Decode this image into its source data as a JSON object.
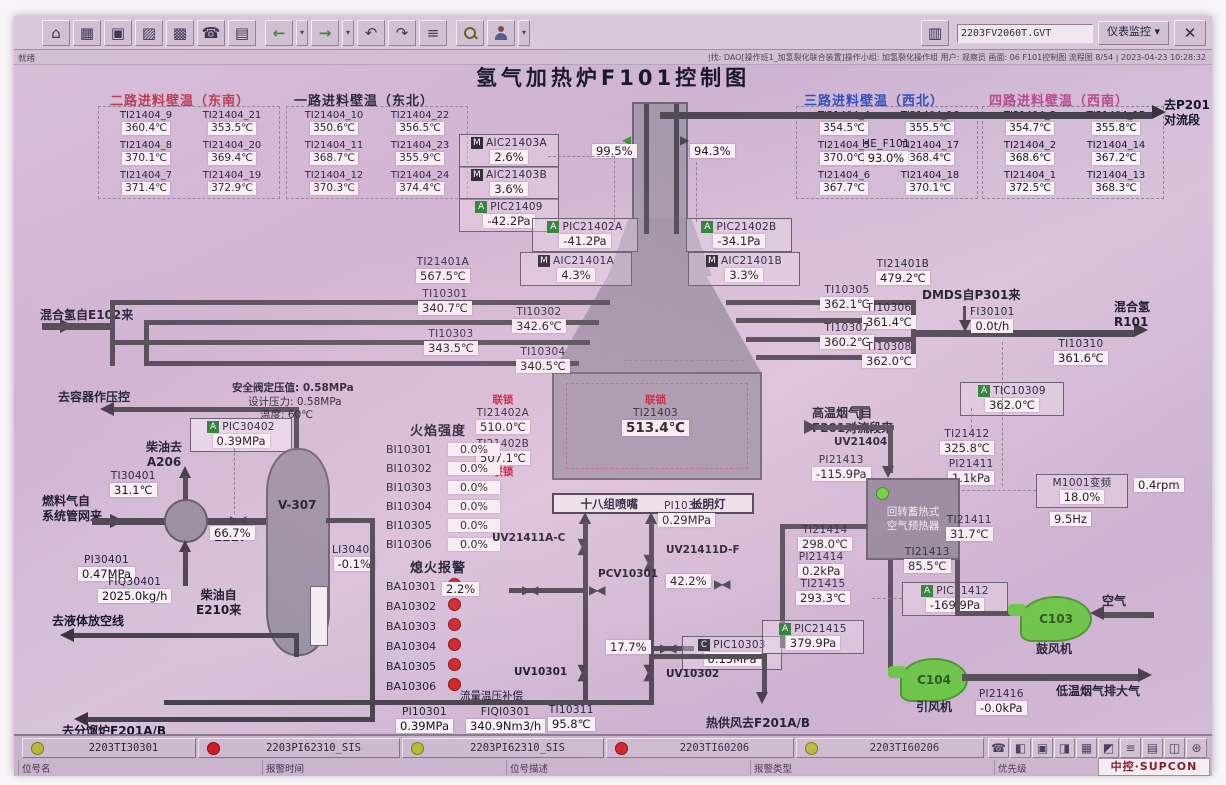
{
  "window": {
    "status_left": "就绪",
    "filename": "2203FV2060T.GVT",
    "view_btn": "仪表监控",
    "close": "✕",
    "info_bar": "|找: DAO[操作班1_加氢裂化联合装置]操作小组: 加氢裂化操作组 用户: 观察员 画面: 06 F101控制图 流程图 8/54 | 2023-04-23 10:28:32",
    "toolbar_icons": [
      {
        "name": "home",
        "glyph": "⌂"
      },
      {
        "name": "flowsheet",
        "glyph": "▦"
      },
      {
        "name": "monitor",
        "glyph": "▣"
      },
      {
        "name": "factory",
        "glyph": "▨"
      },
      {
        "name": "grid",
        "glyph": "▩"
      },
      {
        "name": "phone",
        "glyph": "☎"
      },
      {
        "name": "report",
        "glyph": "▤"
      },
      {
        "name": "back",
        "glyph": "←"
      },
      {
        "name": "forward",
        "glyph": "→"
      },
      {
        "name": "page-prev",
        "glyph": "↶"
      },
      {
        "name": "page-next",
        "glyph": "↷"
      },
      {
        "name": "book",
        "glyph": "≡"
      }
    ],
    "sys_icons": [
      {
        "name": "phone",
        "glyph": "☎"
      },
      {
        "name": "lock",
        "glyph": "◧"
      },
      {
        "name": "monitor",
        "glyph": "▣"
      },
      {
        "name": "printer",
        "glyph": "◨"
      },
      {
        "name": "table",
        "glyph": "▦"
      },
      {
        "name": "alarm",
        "glyph": "◩"
      },
      {
        "name": "list",
        "glyph": "≡"
      },
      {
        "name": "report",
        "glyph": "▤"
      },
      {
        "name": "window",
        "glyph": "◫"
      },
      {
        "name": "settings",
        "glyph": "⊛"
      }
    ]
  },
  "title": "氢气加热炉F101控制图",
  "feed_tables": [
    {
      "header": "二路进料壁温（东南）",
      "color": "#b5344e",
      "rows": [
        [
          "TI21404_9",
          "360.4℃",
          "TI21404_21",
          "353.5℃"
        ],
        [
          "TI21404_8",
          "370.1℃",
          "TI21404_20",
          "369.4℃"
        ],
        [
          "TI21404_7",
          "371.4℃",
          "TI21404_19",
          "372.9℃"
        ]
      ]
    },
    {
      "header": "一路进料壁温（东北）",
      "color": "#1c1c2e",
      "rows": [
        [
          "TI21404_10",
          "350.6℃",
          "TI21404_22",
          "356.5℃"
        ],
        [
          "TI21404_11",
          "368.7℃",
          "TI21404_23",
          "355.9℃"
        ],
        [
          "TI21404_12",
          "370.3℃",
          "TI21404_24",
          "374.4℃"
        ]
      ]
    },
    {
      "header": "三路进料壁温（西北）",
      "color": "#2a4fc0",
      "rows": [
        [
          "TI21404_4",
          "354.5℃",
          "TI21404_16",
          "355.5℃"
        ],
        [
          "TI21404_5",
          "370.0℃",
          "TI21404_17",
          "368.4℃"
        ],
        [
          "TI21404_6",
          "367.7℃",
          "TI21404_18",
          "370.1℃"
        ]
      ]
    },
    {
      "header": "四路进料壁温（西南）",
      "color": "#b84a8c",
      "rows": [
        [
          "TI21404_3",
          "354.7℃",
          "TI21404_15",
          "355.8℃"
        ],
        [
          "TI21404_2",
          "368.6℃",
          "TI21404_14",
          "367.2℃"
        ],
        [
          "TI21404_1",
          "372.5℃",
          "TI21404_13",
          "368.3℃"
        ]
      ]
    }
  ],
  "inst": {
    "aic21403a": {
      "mode": "M",
      "tag": "AIC21403A",
      "value": "2.6%"
    },
    "aic21403b": {
      "mode": "M",
      "tag": "AIC21403B",
      "value": "3.6%"
    },
    "pic21409": {
      "mode": "A",
      "tag": "PIC21409",
      "value": "-42.2Pa"
    },
    "pic21402a": {
      "mode": "A",
      "tag": "PIC21402A",
      "value": "-41.2Pa"
    },
    "pic21402b": {
      "mode": "A",
      "tag": "PIC21402B",
      "value": "-34.1Pa"
    },
    "aic21401a": {
      "mode": "M",
      "tag": "AIC21401A",
      "value": "4.3%"
    },
    "aic21401b": {
      "mode": "M",
      "tag": "AIC21401B",
      "value": "3.3%"
    },
    "he_f101": {
      "tag": "HE_F101",
      "value": "93.0%"
    },
    "damper_a": {
      "value": "99.5%"
    },
    "damper_b": {
      "value": "94.3%"
    },
    "ti21401a": {
      "tag": "TI21401A",
      "value": "567.5℃"
    },
    "ti21401b": {
      "tag": "TI21401B",
      "value": "479.2℃"
    },
    "ti10301": {
      "tag": "TI10301",
      "value": "340.7℃"
    },
    "ti10302": {
      "tag": "TI10302",
      "value": "342.6℃"
    },
    "ti10303": {
      "tag": "TI10303",
      "value": "343.5℃"
    },
    "ti10304": {
      "tag": "TI10304",
      "value": "340.5℃"
    },
    "ti10305": {
      "tag": "TI10305",
      "value": "362.1℃"
    },
    "ti10306": {
      "tag": "TI10306",
      "value": "361.4℃"
    },
    "ti10307": {
      "tag": "TI10307",
      "value": "360.2℃"
    },
    "ti10308": {
      "tag": "TI10308",
      "value": "362.0℃"
    },
    "fi30101": {
      "tag": "FI30101",
      "value": "0.0t/h"
    },
    "ti10310": {
      "tag": "TI10310",
      "value": "361.6℃"
    },
    "tic10309": {
      "mode": "A",
      "tag": "TIC10309",
      "value": "362.0℃"
    },
    "ti21402a": {
      "tag": "TI21402A",
      "value": "510.0℃"
    },
    "ti21402b": {
      "tag": "TI21402B",
      "value": "507.1℃"
    },
    "ti21403": {
      "tag": "TI21403",
      "value": "513.4℃"
    },
    "pic30402": {
      "mode": "A",
      "tag": "PIC30402",
      "value": "0.39MPa"
    },
    "ti30401": {
      "tag": "TI30401",
      "value": "31.1℃"
    },
    "pi30401": {
      "tag": "PI30401",
      "value": "0.47MPa"
    },
    "fiq30401": {
      "tag": "FIQ30401",
      "value": "2025.0kg/h"
    },
    "li30401": {
      "tag": "LI30401",
      "value": "-0.1%"
    },
    "valve_e217": {
      "value": "66.7%"
    },
    "pi10302": {
      "tag": "PI10302",
      "value": "0.29MPa"
    },
    "pic10303": {
      "mode": "C",
      "tag": "PIC10303",
      "value": "0.15MPa"
    },
    "valve_22": {
      "value": "2.2%"
    },
    "valve_422": {
      "value": "42.2%"
    },
    "valve_177": {
      "value": "17.7%"
    },
    "pi10301": {
      "tag": "PI10301",
      "value": "0.39MPa"
    },
    "fiqi0301": {
      "tag": "FIQI0301",
      "value": "340.9Nm3/h"
    },
    "ti10311": {
      "tag": "TI10311",
      "value": "95.8℃"
    },
    "uv10301": "UV10301",
    "uv10302": "UV10302",
    "pcv10301": "PCV10301",
    "uv21411ac": "UV21411A-C",
    "uv21411df": "UV21411D-F",
    "uv21404": "UV21404",
    "ti21412": {
      "tag": "TI21412",
      "value": "325.8℃"
    },
    "pi21413": {
      "tag": "PI21413",
      "value": "-115.9Pa"
    },
    "pi21411": {
      "tag": "PI21411",
      "value": "1.1kPa"
    },
    "m1001": {
      "tag": "M1001变频",
      "value": "18.0%",
      "value2": "9.5Hz",
      "rpm": "0.4rpm"
    },
    "ti21411": {
      "tag": "TI21411",
      "value": "31.7℃"
    },
    "ti21414": {
      "tag": "TI21414",
      "value": "298.0℃"
    },
    "pi21414": {
      "tag": "PI21414",
      "value": "0.2kPa"
    },
    "ti21413": {
      "tag": "TI21413",
      "value": "85.5℃"
    },
    "ti21415": {
      "tag": "TI21415",
      "value": "293.3℃"
    },
    "pic21412": {
      "mode": "A",
      "tag": "PIC21412",
      "value": "-169.9Pa"
    },
    "pic21415": {
      "mode": "A",
      "tag": "PIC21415",
      "value": "379.9Pa"
    },
    "pi21416": {
      "tag": "PI21416",
      "value": "-0.0kPa"
    }
  },
  "flame": {
    "header": "火焰强度",
    "rows": [
      {
        "tag": "BI10301",
        "value": "0.0%"
      },
      {
        "tag": "BI10302",
        "value": "0.0%"
      },
      {
        "tag": "BI10303",
        "value": "0.0%"
      },
      {
        "tag": "BI10304",
        "value": "0.0%"
      },
      {
        "tag": "BI10305",
        "value": "0.0%"
      },
      {
        "tag": "BI10306",
        "value": "0.0%"
      }
    ]
  },
  "flameout": {
    "header": "熄火报警",
    "tags": [
      "BA10301",
      "BA10302",
      "BA10303",
      "BA10304",
      "BA10305",
      "BA10306"
    ]
  },
  "equip": {
    "v307": "V-307",
    "e217": "E217",
    "c103": "C103",
    "c104": "C104",
    "blower": "鼓风机",
    "idfan": "引风机",
    "preheater1": "回转蓄热式",
    "preheater2": "空气预热器",
    "burners": "十八组喷嘴",
    "pilot": "长明灯",
    "interlock": "联锁"
  },
  "labels": {
    "to_p201_1": "去P201",
    "to_p201_2": "对流段",
    "mix_h2_from": "混合氢自E102来",
    "mix_h2_to1": "混合氢",
    "mix_h2_to2": "R101",
    "dmds": "DMDS自P301来",
    "to_vessel": "去容器作压控",
    "safety": "安全阀定压值: 0.58MPa",
    "design": "设计压力: 0.58MPa",
    "temp": "温度: 60℃",
    "diesel_to1": "柴油去",
    "diesel_to2": "A206",
    "fuel_from1": "燃料气自",
    "fuel_from2": "系统管网来",
    "diesel_from1": "柴油自",
    "diesel_from2": "E210来",
    "to_vent": "去液体放空线",
    "to_f201": "去分馏炉F201A/B",
    "hot_air": "热供风去F201A/B",
    "flow_comp": "流量温压补偿",
    "flue_from1": "高温烟气自",
    "flue_from2": "F201对流段来",
    "air": "空气",
    "flue_out": "低温烟气排大气"
  },
  "alarm_bar": {
    "items": [
      {
        "color": "#b9ba33",
        "tag": "2203TI30301"
      },
      {
        "color": "#cf1f24",
        "tag": "2203PI62310_SIS"
      },
      {
        "color": "#b9ba33",
        "tag": "2203PI62310_SIS"
      },
      {
        "color": "#cf1f24",
        "tag": "2203TI60206"
      },
      {
        "color": "#b9ba33",
        "tag": "2203TI60206"
      }
    ],
    "labels": [
      "位号名",
      "报警时间",
      "位号描述",
      "报警类型",
      "优先级"
    ],
    "logo": "中控·SUPCON"
  }
}
